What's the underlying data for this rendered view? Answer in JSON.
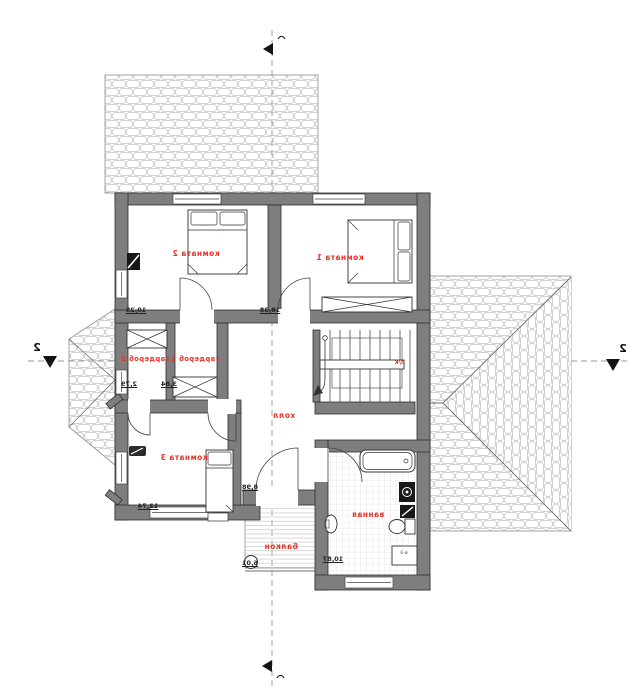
{
  "plan": {
    "rooms": [
      {
        "name": "комната 2",
        "area": "10,25"
      },
      {
        "name": "комната 1",
        "area": "18,38"
      },
      {
        "name": "гардероб 2",
        "area": "2,79"
      },
      {
        "name": "гардероб 1",
        "area": "3,84"
      },
      {
        "name": "холл",
        "area": "8,98"
      },
      {
        "name": "комната 3",
        "area": "12,74"
      },
      {
        "name": "ванная",
        "area": "10,87"
      },
      {
        "name": "балкон",
        "area": "6,01"
      }
    ],
    "stair_label": "л/к",
    "vent_box_label": "в-3",
    "section_marks": {
      "left": "2",
      "right": "2"
    },
    "colors": {
      "wall": "#7e7e7e",
      "room_label": "#e33428",
      "line": "#2e2e2e",
      "roof_hatch": "#c2c2c2",
      "tile": "#dcdcdc"
    }
  }
}
